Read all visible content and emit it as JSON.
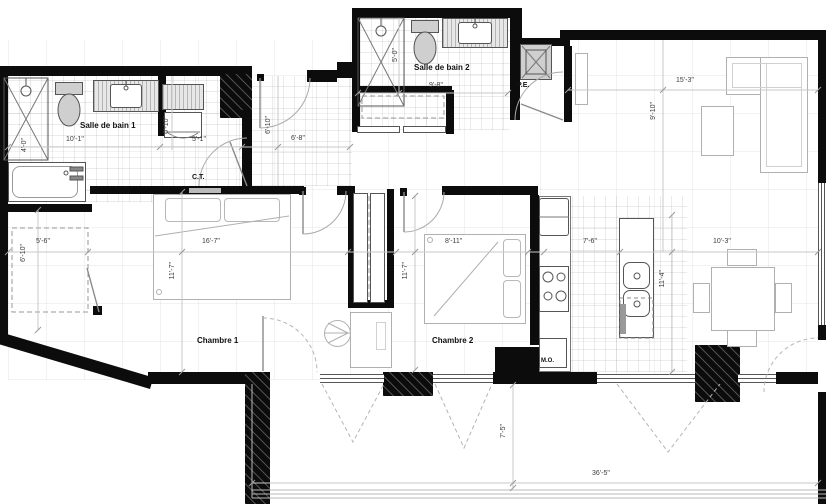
{
  "rooms": {
    "bath1": "Salle de bain 1",
    "bath2": "Salle de bain 2",
    "bed1": "Chambre 1",
    "bed2": "Chambre 2"
  },
  "labels": {
    "ct": "C.T.",
    "pe": "P.E.",
    "mo": "M.O."
  },
  "dimensions": {
    "bath1_w": "10'-1\"",
    "bath1_shower": "4'-0\"",
    "wd_h": "6'-10\"",
    "wd_w": "5'-1\"",
    "hall_h": "6'-10\"",
    "hall_w": "6'-8\"",
    "bath2_h": "5'-0\"",
    "bath2_w": "9'-8\"",
    "living_w": "15'-3\"",
    "living_h": "9'-10\"",
    "wic_w": "5'-6\"",
    "wic_h": "6'-10\"",
    "bed1_w": "16'-7\"",
    "bed1_h": "11'-7\"",
    "bed2_w": "8'-11\"",
    "bed2_h": "11'-7\"",
    "kitchen_w": "7'-6\"",
    "kitchen_h": "11'-4\"",
    "dining_w": "10'-3\"",
    "balcony_d": "7'-5\"",
    "balcony_w": "36'-5\""
  },
  "colors": {
    "wall": "#0c0c0c",
    "fixture_line": "#555555",
    "furniture_line": "#b0b0b0",
    "dim_line": "#c8c8c8"
  }
}
